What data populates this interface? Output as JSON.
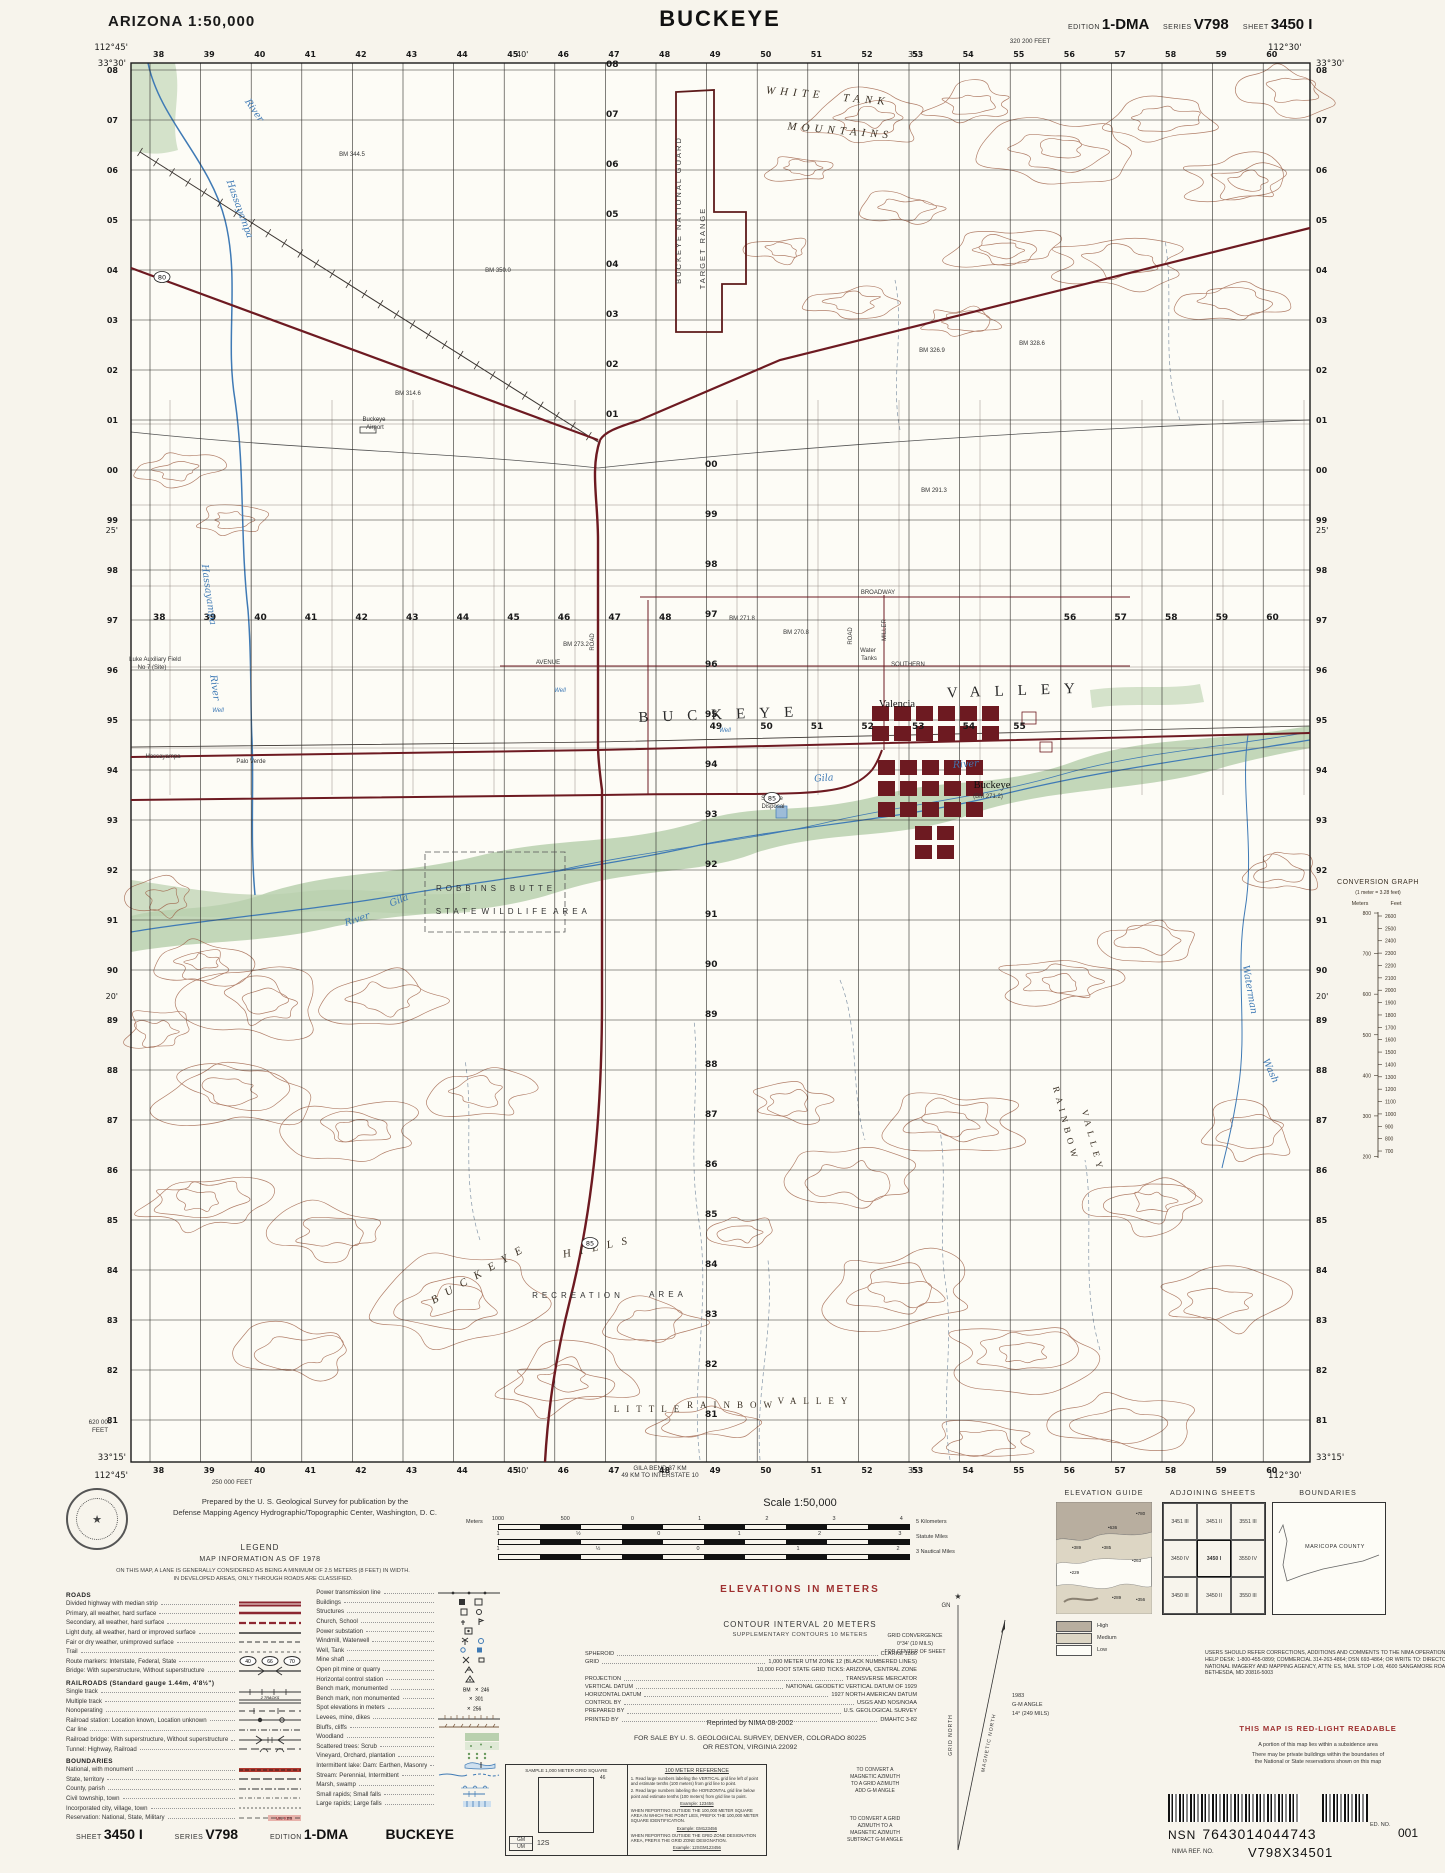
{
  "header": {
    "state_scale": "ARIZONA  1:50,000",
    "title": "BUCKEYE",
    "edition_label": "EDITION",
    "edition": "1-DMA",
    "series_label": "SERIES",
    "series": "V798",
    "sheet_label": "SHEET",
    "sheet": "3450 I"
  },
  "map": {
    "corner_coords": {
      "tl_lon": "112°45'",
      "tl_lat": "33°30'",
      "tr_lon": "112°30'",
      "tr_lat": "33°30'",
      "bl_lat": "33°15'",
      "bl_lon": "112°45'",
      "br_lat": "33°15'",
      "br_lon": "112°30'"
    },
    "eastings": [
      "38",
      "39",
      "40",
      "41",
      "42",
      "43",
      "44",
      "45",
      "46",
      "47",
      "48",
      "49",
      "50",
      "51",
      "52",
      "53",
      "54",
      "55",
      "56",
      "57",
      "58",
      "59",
      "60"
    ],
    "northings": [
      "08",
      "07",
      "06",
      "05",
      "04",
      "03",
      "02",
      "01",
      "00",
      "99",
      "98",
      "97",
      "96",
      "95",
      "94",
      "93",
      "92",
      "91",
      "90",
      "89",
      "88",
      "87",
      "86",
      "85",
      "84",
      "83",
      "82",
      "81"
    ],
    "lon_ticks": [
      {
        "t": "40'",
        "x": 516
      },
      {
        "t": "35'",
        "x": 908
      }
    ],
    "lat_ticks": [
      {
        "t": "25'",
        "y": 533
      },
      {
        "t": "20'",
        "y": 999
      }
    ],
    "edge_notes": [
      {
        "t": "320 200 FEET",
        "x": 1030,
        "y": 43
      },
      {
        "t": "620 000",
        "x": 100,
        "y": 1424
      },
      {
        "t": "FEET",
        "x": 100,
        "y": 1432
      },
      {
        "t": "250 000 FEET",
        "x": 232,
        "y": 1484
      },
      {
        "t": "GILA BEND 37 KM",
        "x": 660,
        "y": 1470
      },
      {
        "t": "49 KM TO INTERSTATE 10",
        "x": 660,
        "y": 1477
      }
    ],
    "route_shields": [
      {
        "n": "85",
        "x": 772,
        "y": 798
      },
      {
        "n": "85",
        "x": 590,
        "y": 1243
      },
      {
        "n": "80",
        "x": 162,
        "y": 277
      }
    ],
    "labels": [
      {
        "t": "WHITE",
        "x": 795,
        "y": 96,
        "c": "mtn",
        "ls": 5,
        "r": 5
      },
      {
        "t": "TANK",
        "x": 866,
        "y": 103,
        "c": "mtn",
        "ls": 5,
        "r": 5
      },
      {
        "t": "MOUNTAINS",
        "x": 840,
        "y": 134,
        "c": "mtn",
        "ls": 5,
        "r": 5
      },
      {
        "t": "BUCKEYE  NATIONAL  GUARD",
        "x": 681,
        "y": 210,
        "c": "bnd",
        "r": -90
      },
      {
        "t": "TARGET  RANGE",
        "x": 705,
        "y": 248,
        "c": "bnd",
        "r": -90
      },
      {
        "t": "Buckeye",
        "x": 374,
        "y": 421,
        "c": "tn"
      },
      {
        "t": "Airport",
        "x": 375,
        "y": 429,
        "c": "tn"
      },
      {
        "t": "BUCKEYE",
        "x": 723,
        "y": 719,
        "c": "valley",
        "ls": 14,
        "r": -2
      },
      {
        "t": "VALLEY",
        "x": 1018,
        "y": 695,
        "c": "valley",
        "ls": 14,
        "r": -2
      },
      {
        "t": "Valencia",
        "x": 897,
        "y": 707,
        "c": "place"
      },
      {
        "t": "Buckeye",
        "x": 992,
        "y": 788,
        "c": "place"
      },
      {
        "t": "(BM 271.2)",
        "x": 988,
        "y": 798,
        "c": "tn"
      },
      {
        "t": "Hassayampa",
        "x": 237,
        "y": 210,
        "c": "wtr",
        "r": 70
      },
      {
        "t": "River",
        "x": 252,
        "y": 112,
        "c": "wtr",
        "r": 55
      },
      {
        "t": "Hassayampa",
        "x": 206,
        "y": 595,
        "c": "wtr",
        "r": 82
      },
      {
        "t": "River",
        "x": 212,
        "y": 688,
        "c": "wtr",
        "r": 82
      },
      {
        "t": "Hassayampa",
        "x": 163,
        "y": 758,
        "c": "tn"
      },
      {
        "t": "Palo Verde",
        "x": 251,
        "y": 763,
        "c": "tn"
      },
      {
        "t": "Luke Auxiliary Field",
        "x": 155,
        "y": 661,
        "c": "tn"
      },
      {
        "t": "No 7 (Site)",
        "x": 152,
        "y": 669,
        "c": "tn"
      },
      {
        "t": "Gila",
        "x": 824,
        "y": 781,
        "c": "wtr",
        "r": -4
      },
      {
        "t": "River",
        "x": 966,
        "y": 767,
        "c": "wtr",
        "r": -4
      },
      {
        "t": "Gila",
        "x": 400,
        "y": 903,
        "c": "wtr",
        "r": -22
      },
      {
        "t": "River",
        "x": 358,
        "y": 922,
        "c": "wtr",
        "r": -18
      },
      {
        "t": "Waterman",
        "x": 1247,
        "y": 990,
        "c": "wtr",
        "r": 80
      },
      {
        "t": "Wash",
        "x": 1268,
        "y": 1072,
        "c": "wtr",
        "r": 65
      },
      {
        "t": "ROBBINS",
        "x": 468,
        "y": 891,
        "c": "area",
        "ls": 4
      },
      {
        "t": "BUTTE",
        "x": 533,
        "y": 891,
        "c": "area",
        "ls": 4
      },
      {
        "t": "STATE",
        "x": 458,
        "y": 914,
        "c": "area",
        "ls": 4
      },
      {
        "t": "WILDLIFE",
        "x": 516,
        "y": 914,
        "c": "area",
        "ls": 4
      },
      {
        "t": "AREA",
        "x": 572,
        "y": 914,
        "c": "area",
        "ls": 4
      },
      {
        "t": "BUCKEYE",
        "x": 482,
        "y": 1276,
        "c": "mtn",
        "r": -30,
        "ls": 9
      },
      {
        "t": "HILLS",
        "x": 600,
        "y": 1250,
        "c": "mtn",
        "r": -12,
        "ls": 9
      },
      {
        "t": "RECREATION",
        "x": 578,
        "y": 1298,
        "c": "area",
        "ls": 4
      },
      {
        "t": "AREA",
        "x": 668,
        "y": 1297,
        "c": "area",
        "ls": 4
      },
      {
        "t": "LITTLE",
        "x": 650,
        "y": 1412,
        "c": "vsm",
        "ls": 7
      },
      {
        "t": "RAINBOW",
        "x": 733,
        "y": 1408,
        "c": "vsm",
        "ls": 7
      },
      {
        "t": "VALLEY",
        "x": 816,
        "y": 1404,
        "c": "vsm",
        "ls": 7
      },
      {
        "t": "RAINBOW",
        "x": 1063,
        "y": 1125,
        "c": "vsm",
        "r": 75,
        "ls": 5
      },
      {
        "t": "VALLEY",
        "x": 1090,
        "y": 1142,
        "c": "vsm",
        "r": 75,
        "ls": 5
      },
      {
        "t": "BROADWAY",
        "x": 878,
        "y": 594,
        "c": "rd"
      },
      {
        "t": "SOUTHERN",
        "x": 908,
        "y": 666,
        "c": "rd"
      },
      {
        "t": "AVENUE",
        "x": 548,
        "y": 664,
        "c": "rd"
      },
      {
        "t": "MILLER",
        "x": 886,
        "y": 630,
        "c": "rd",
        "r": -90
      },
      {
        "t": "ROAD",
        "x": 594,
        "y": 642,
        "c": "rd",
        "r": -90
      },
      {
        "t": "ROAD",
        "x": 852,
        "y": 636,
        "c": "rd",
        "r": -90
      },
      {
        "t": "Water",
        "x": 868,
        "y": 652,
        "c": "tn"
      },
      {
        "t": "Tanks",
        "x": 869,
        "y": 660,
        "c": "tn"
      },
      {
        "t": "Sewage",
        "x": 772,
        "y": 800,
        "c": "tn"
      },
      {
        "t": "Disposal",
        "x": 773,
        "y": 808,
        "c": "tn"
      },
      {
        "t": "Well",
        "x": 218,
        "y": 712,
        "c": "tnb"
      },
      {
        "t": "Well",
        "x": 560,
        "y": 692,
        "c": "tnb"
      },
      {
        "t": "Well",
        "x": 725,
        "y": 732,
        "c": "tnb"
      },
      {
        "t": "BM 344.5",
        "x": 352,
        "y": 156,
        "c": "tn"
      },
      {
        "t": "BM 350.0",
        "x": 498,
        "y": 272,
        "c": "tn"
      },
      {
        "t": "BM 326.9",
        "x": 932,
        "y": 352,
        "c": "tn"
      },
      {
        "t": "BM 328.6",
        "x": 1032,
        "y": 345,
        "c": "tn"
      },
      {
        "t": "BM 291.3",
        "x": 934,
        "y": 492,
        "c": "tn"
      },
      {
        "t": "BM 271.8",
        "x": 742,
        "y": 620,
        "c": "tn"
      },
      {
        "t": "BM 270.8",
        "x": 796,
        "y": 634,
        "c": "tn"
      },
      {
        "t": "BM 273.2",
        "x": 576,
        "y": 646,
        "c": "tn"
      },
      {
        "t": "BM 314.6",
        "x": 408,
        "y": 395,
        "c": "tn"
      }
    ]
  },
  "conversion_graph": {
    "title": "CONVERSION GRAPH",
    "subtitle": "(1 meter = 3.28 feet)",
    "col_meters": "Meters",
    "col_feet": "Feet",
    "meters": [
      "800",
      "700",
      "600",
      "500",
      "400",
      "300",
      "200"
    ],
    "feet": [
      "2600",
      "2500",
      "2400",
      "2300",
      "2200",
      "2100",
      "2000",
      "1900",
      "1800",
      "1700",
      "1600",
      "1500",
      "1400",
      "1300",
      "1200",
      "1100",
      "1000",
      "900",
      "800",
      "700"
    ]
  },
  "credits": {
    "line1": "Prepared by the U. S. Geological Survey for publication by the",
    "line2": "Defense Mapping Agency Hydrographic/Topographic Center, Washington, D. C."
  },
  "legend": {
    "title": "LEGEND",
    "info": "MAP INFORMATION AS OF 1978",
    "note1": "ON THIS MAP, A LANE IS GENERALLY CONSIDERED AS BEING A MINIMUM OF 2.5 METERS (8 FEET) IN WIDTH.",
    "note2": "IN DEVELOPED AREAS, ONLY THROUGH ROADS ARE CLASSIFIED.",
    "col_a": [
      {
        "h": "ROADS"
      },
      {
        "t": "Divided highway with median strip",
        "s": "hwy2"
      },
      {
        "t": "Primary, all weather, hard surface",
        "s": "hwy1"
      },
      {
        "t": "Secondary, all weather, hard surface",
        "s": "hwysec"
      },
      {
        "t": "Light duty, all weather, hard or improved surface",
        "s": "light"
      },
      {
        "t": "Fair or dry weather, unimproved surface",
        "s": "fair"
      },
      {
        "t": "Trail",
        "s": "trail"
      },
      {
        "t": "Route markers: Interstate, Federal, State",
        "s": "shields"
      },
      {
        "t": "Bridge: With superstructure, Without superstructure",
        "s": "bridge"
      },
      {
        "h": "RAILROADS (Standard gauge 1.44m, 4'8½\")"
      },
      {
        "t": "Single track",
        "s": "rr"
      },
      {
        "t": "Multiple track",
        "s": "rr2"
      },
      {
        "t": "Nonoperating",
        "s": "rrnon"
      },
      {
        "t": "Railroad station: Location known, Location unknown",
        "s": "rrsta"
      },
      {
        "t": "Car line",
        "s": "carline"
      },
      {
        "t": "Railroad bridge: With superstructure, Without superstructure",
        "s": "rrbridge"
      },
      {
        "t": "Tunnel: Highway, Railroad",
        "s": "tunnel"
      },
      {
        "h": "BOUNDARIES"
      },
      {
        "t": "National, with monument",
        "s": "bndnat"
      },
      {
        "t": "State, territory",
        "s": "bndstate"
      },
      {
        "t": "County, parish",
        "s": "bndcounty"
      },
      {
        "t": "Civil township, town",
        "s": "bndtwp"
      },
      {
        "t": "Incorporated city, village, town",
        "s": "bndcity"
      },
      {
        "t": "Reservation: National, State, Military",
        "s": "milres"
      }
    ],
    "col_b": [
      {
        "t": "Power transmission line",
        "s": "power"
      },
      {
        "t": "Buildings",
        "s": "bldg"
      },
      {
        "t": "Structures",
        "s": "struct"
      },
      {
        "t": "Church, School",
        "s": "church"
      },
      {
        "t": "Power substation",
        "s": "substa"
      },
      {
        "t": "Windmill, Waterwell",
        "s": "windmill"
      },
      {
        "t": "Well, Tank",
        "s": "well"
      },
      {
        "t": "Mine shaft",
        "s": "mine"
      },
      {
        "t": "Open pit mine or quarry",
        "s": "quarry"
      },
      {
        "t": "Horizontal control station",
        "s": "hcs"
      },
      {
        "t": "Bench mark, monumented",
        "s": "bm1"
      },
      {
        "t": "Bench mark, non monumented",
        "s": "bm2"
      },
      {
        "t": "Spot elevations in meters",
        "s": "spot"
      },
      {
        "t": "Levees, mine, dikes",
        "s": "levee"
      },
      {
        "t": "Bluffs, cliffs",
        "s": "bluff"
      },
      {
        "t": "Woodland",
        "s": "wood"
      },
      {
        "t": "Scattered trees: Scrub",
        "s": "scrub"
      },
      {
        "t": "Vineyard, Orchard, plantation",
        "s": "orchard"
      },
      {
        "t": "Intermittent lake: Dam: Earthen, Masonry",
        "s": "lake"
      },
      {
        "t": "Stream: Perennial, Intermittent",
        "s": "stream"
      },
      {
        "t": "Marsh, swamp",
        "s": "marsh"
      },
      {
        "t": "Small rapids; Small falls",
        "s": "rapidss"
      },
      {
        "t": "Large rapids; Large falls",
        "s": "rapidsl"
      }
    ]
  },
  "sheet_line": {
    "sheet_label": "SHEET",
    "sheet": "3450 I",
    "series_label": "SERIES",
    "series": "V798",
    "edition_label": "EDITION",
    "edition": "1-DMA",
    "title": "BUCKEYE"
  },
  "scale": {
    "title": "Scale 1:50,000",
    "bars": [
      {
        "pre": "Meters",
        "ticks": [
          "1000",
          "500",
          "0",
          "1",
          "2",
          "3",
          "4"
        ],
        "post": "5 Kilometers"
      },
      {
        "pre": "",
        "ticks": [
          "1",
          "½",
          "0",
          "1",
          "2",
          "3"
        ],
        "post": "Statute Miles"
      },
      {
        "pre": "",
        "ticks": [
          "1",
          "½",
          "0",
          "1",
          "2"
        ],
        "post": "3 Nautical Miles"
      }
    ]
  },
  "elevations": {
    "red_title": "ELEVATIONS IN METERS",
    "contour": "CONTOUR INTERVAL 20 METERS",
    "supp": "SUPPLEMENTARY CONTOURS 10 METERS"
  },
  "datums": [
    {
      "l": "SPHEROID",
      "v": "CLARKE 1866"
    },
    {
      "l": "GRID",
      "v": "1,000 METER UTM ZONE 12 (BLACK NUMBERED LINES)",
      "v2": "10,000 FOOT STATE GRID TICKS: ARIZONA, CENTRAL ZONE"
    },
    {
      "l": "PROJECTION",
      "v": "TRANSVERSE MERCATOR"
    },
    {
      "l": "VERTICAL DATUM",
      "v": "NATIONAL GEODETIC VERTICAL DATUM OF 1929"
    },
    {
      "l": "HORIZONTAL DATUM",
      "v": "1927 NORTH AMERICAN DATUM"
    },
    {
      "l": "CONTROL BY",
      "v": "USGS AND NOS/NOAA"
    },
    {
      "l": "PREPARED BY",
      "v": "U.S. GEOLOGICAL SURVEY"
    },
    {
      "l": "PRINTED BY",
      "v": "DMAHTC 3-82"
    }
  ],
  "reprint": "Reprinted by NIMA 08-2002",
  "sale1": "FOR SALE BY U. S. GEOLOGICAL SURVEY, DENVER, COLORADO 80225",
  "sale2": "OR RESTON, VIRGINIA 22092",
  "sample_box": {
    "title": "SAMPLE 1,000 METER GRID SQUARE",
    "grid_number": "46",
    "zone": "12S",
    "sq1": "GM",
    "sq2": "UM"
  },
  "reference_box": {
    "title": "100 METER REFERENCE",
    "lines": [
      "1. Read large numbers labeling the VERTICAL grid line left of point and estimate tenths (100 meters) from grid line to point.",
      "2. Read large numbers labeling the HORIZONTAL grid line below point and estimate tenths (100 meters) from grid line to point.",
      "Example: 123456",
      "WHEN REPORTING OUTSIDE THE 100,000 METER SQUARE AREA IN WHICH THE POINT LIES, PREFIX THE 100,000 METER SQUARE IDENTIFICATION.",
      "Example: GM123456",
      "WHEN REPORTING OUTSIDE THE GRID ZONE DESIGNATION AREA, PREFIX THE GRID ZONE DESIGNATION.",
      "Example: 12SGM123456"
    ]
  },
  "declination": {
    "gn": "GN",
    "grid_north": "GRID NORTH",
    "magnetic_north": "MAGNETIC NORTH",
    "year": "1983",
    "gm_label": "G-M ANGLE",
    "gm_value": "14° (249 MILS)",
    "convergence1": "GRID CONVERGENCE",
    "convergence2": "0°34' (10 MILS)",
    "convergence3": "FOR CENTER OF SHEET",
    "convert1": "TO CONVERT A MAGNETIC AZIMUTH TO A GRID AZIMUTH ADD G-M ANGLE",
    "convert2": "TO CONVERT A GRID AZIMUTH TO A MAGNETIC AZIMUTH SUBTRACT G-M ANGLE"
  },
  "elevation_guide": {
    "title": "ELEVATION GUIDE",
    "values": [
      {
        "t": "780",
        "x": 80,
        "y": 13
      },
      {
        "t": "636",
        "x": 52,
        "y": 27
      },
      {
        "t": "389",
        "x": 16,
        "y": 47
      },
      {
        "t": "385",
        "x": 46,
        "y": 47
      },
      {
        "t": "263",
        "x": 76,
        "y": 60
      },
      {
        "t": "229",
        "x": 14,
        "y": 72
      },
      {
        "t": "289",
        "x": 56,
        "y": 97
      },
      {
        "t": "356",
        "x": 80,
        "y": 99
      }
    ],
    "legend": [
      "High",
      "Medium",
      "Low"
    ]
  },
  "adjoining": {
    "title": "ADJOINING SHEETS",
    "cells": [
      [
        "3451 III",
        "3451 II",
        "3551 III"
      ],
      [
        "3450 IV",
        "3450 I",
        "3550 IV"
      ],
      [
        "3450 III",
        "3450 II",
        "3550 III"
      ]
    ]
  },
  "boundaries": {
    "title": "BOUNDARIES",
    "label": "MARICOPA COUNTY"
  },
  "notes": {
    "users": "USERS SHOULD REFER CORRECTIONS, ADDITIONS AND COMMENTS TO THE NIMA OPERATIONAL HELP DESK: 1-800-455-0899; COMMERCIAL 314-263-4864; DSN 693-4864; OR WRITE TO: DIRECTOR, NATIONAL IMAGERY AND MAPPING AGENCY, ATTN: ES, MAIL STOP L-08, 4600 SANGAMORE ROAD, BETHESDA, MD 20816-5003",
    "red_light": "THIS MAP IS RED-LIGHT READABLE",
    "subsidence": "A portion of this map lies within a subsidence area",
    "private1": "There may be private buildings within the boundaries of",
    "private2": "the National or State reservations shown on this map"
  },
  "codes": {
    "nsn_label": "NSN",
    "nsn": "7643014044743",
    "ed_label": "ED. NO.",
    "ed": "001",
    "ref_label": "NIMA REF. NO.",
    "ref": "V798X34501"
  },
  "colors": {
    "road_red": "#6d1a21",
    "water_blue": "#3f7ab5",
    "veg_green": "#b9d0ae",
    "contour_brown": "#9c5c42",
    "margin_red": "#9e2f2f",
    "urban": "#6d1a21"
  }
}
